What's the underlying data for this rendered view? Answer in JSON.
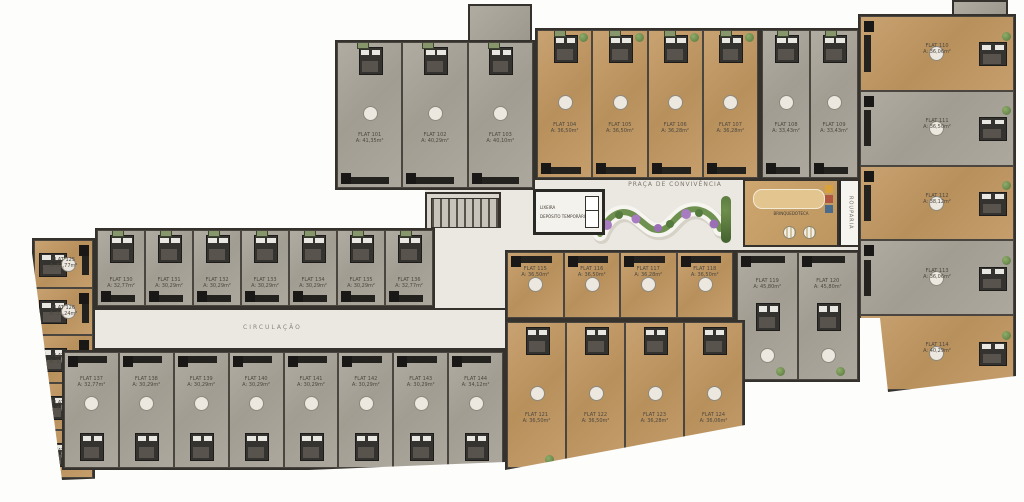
{
  "title": "Pavimento tipo - planta humanizada",
  "labels": {
    "plaza": "PRAÇA DE CONVIVÊNCIA",
    "circulation": "CIRCULAÇÃO",
    "elevator": "ELEVADOR",
    "trash": "LIXEIRA",
    "temp_deposit": "DEPÓSITO TEMPORÁRIO",
    "playroom": "BRINQUEDOTECA",
    "linen": "ROUPARIA"
  },
  "colors": {
    "wood_floor": "#c09a6a",
    "concrete_floor": "#a8a49b",
    "wall": "#35322d",
    "corridor": "#ebe8e2",
    "plant": "#6d8f52",
    "flower": "#a87cc1"
  },
  "sections": {
    "top_left_grey": {
      "units": [
        {
          "label": "FLAT 101",
          "area": "A: 41,35m²"
        },
        {
          "label": "FLAT 102",
          "area": "A: 40,29m²"
        },
        {
          "label": "FLAT 103",
          "area": "A: 40,10m²"
        }
      ]
    },
    "top_wood": {
      "units": [
        {
          "label": "FLAT 104",
          "area": "A: 36,50m²"
        },
        {
          "label": "FLAT 105",
          "area": "A: 36,50m²"
        },
        {
          "label": "FLAT 106",
          "area": "A: 36,28m²"
        },
        {
          "label": "FLAT 107",
          "area": "A: 36,28m²"
        }
      ]
    },
    "top_grey_right": {
      "units": [
        {
          "label": "FLAT 108",
          "area": "A: 33,43m²"
        },
        {
          "label": "FLAT 109",
          "area": "A: 33,43m²"
        }
      ]
    },
    "right_wing": {
      "units": [
        {
          "label": "FLAT 110",
          "area": "A: 36,06m²"
        },
        {
          "label": "FLAT 111",
          "area": "A: 36,50m²"
        },
        {
          "label": "FLAT 112",
          "area": "A: 38,12m²"
        },
        {
          "label": "FLAT 113",
          "area": "A: 36,06m²"
        },
        {
          "label": "FLAT 114",
          "area": "A: 40,29m²"
        }
      ]
    },
    "mid_wood": {
      "units": [
        {
          "label": "FLAT 115",
          "area": "A: 36,50m²"
        },
        {
          "label": "FLAT 116",
          "area": "A: 36,50m²"
        },
        {
          "label": "FLAT 117",
          "area": "A: 36,28m²"
        },
        {
          "label": "FLAT 118",
          "area": "A: 36,50m²"
        }
      ]
    },
    "mid_grey_big": {
      "units": [
        {
          "label": "FLAT 119",
          "area": "A: 45,80m²"
        },
        {
          "label": "FLAT 120",
          "area": "A: 45,80m²"
        }
      ]
    },
    "bottom_wood": {
      "units": [
        {
          "label": "FLAT 121",
          "area": "A: 36,50m²"
        },
        {
          "label": "FLAT 122",
          "area": "A: 36,50m²"
        },
        {
          "label": "FLAT 123",
          "area": "A: 36,28m²"
        },
        {
          "label": "FLAT 124",
          "area": "A: 36,06m²"
        }
      ]
    },
    "left_column": {
      "units": [
        {
          "label": "FLAT 125",
          "area": "A: 32,77m²"
        },
        {
          "label": "FLAT 126",
          "area": "A: 31,24m²"
        },
        {
          "label": "FLAT 127",
          "area": "A: 31,24m²"
        },
        {
          "label": "FLAT 128",
          "area": "A: 31,24m²"
        },
        {
          "label": "FLAT 129",
          "area": "A: 32,77m²"
        }
      ]
    },
    "left_top_row": {
      "units": [
        {
          "label": "FLAT 130",
          "area": "A: 32,77m²"
        },
        {
          "label": "FLAT 131",
          "area": "A: 30,29m²"
        },
        {
          "label": "FLAT 132",
          "area": "A: 30,29m²"
        },
        {
          "label": "FLAT 133",
          "area": "A: 30,29m²"
        },
        {
          "label": "FLAT 134",
          "area": "A: 30,29m²"
        },
        {
          "label": "FLAT 135",
          "area": "A: 30,29m²"
        },
        {
          "label": "FLAT 136",
          "area": "A: 32,77m²"
        }
      ]
    },
    "left_bottom_row": {
      "units": [
        {
          "label": "FLAT 137",
          "area": "A: 32,77m²"
        },
        {
          "label": "FLAT 138",
          "area": "A: 30,29m²"
        },
        {
          "label": "FLAT 139",
          "area": "A: 30,29m²"
        },
        {
          "label": "FLAT 140",
          "area": "A: 30,29m²"
        },
        {
          "label": "FLAT 141",
          "area": "A: 30,29m²"
        },
        {
          "label": "FLAT 142",
          "area": "A: 30,29m²"
        },
        {
          "label": "FLAT 143",
          "area": "A: 30,29m²"
        },
        {
          "label": "FLAT 144",
          "area": "A: 34,12m²"
        }
      ]
    }
  }
}
